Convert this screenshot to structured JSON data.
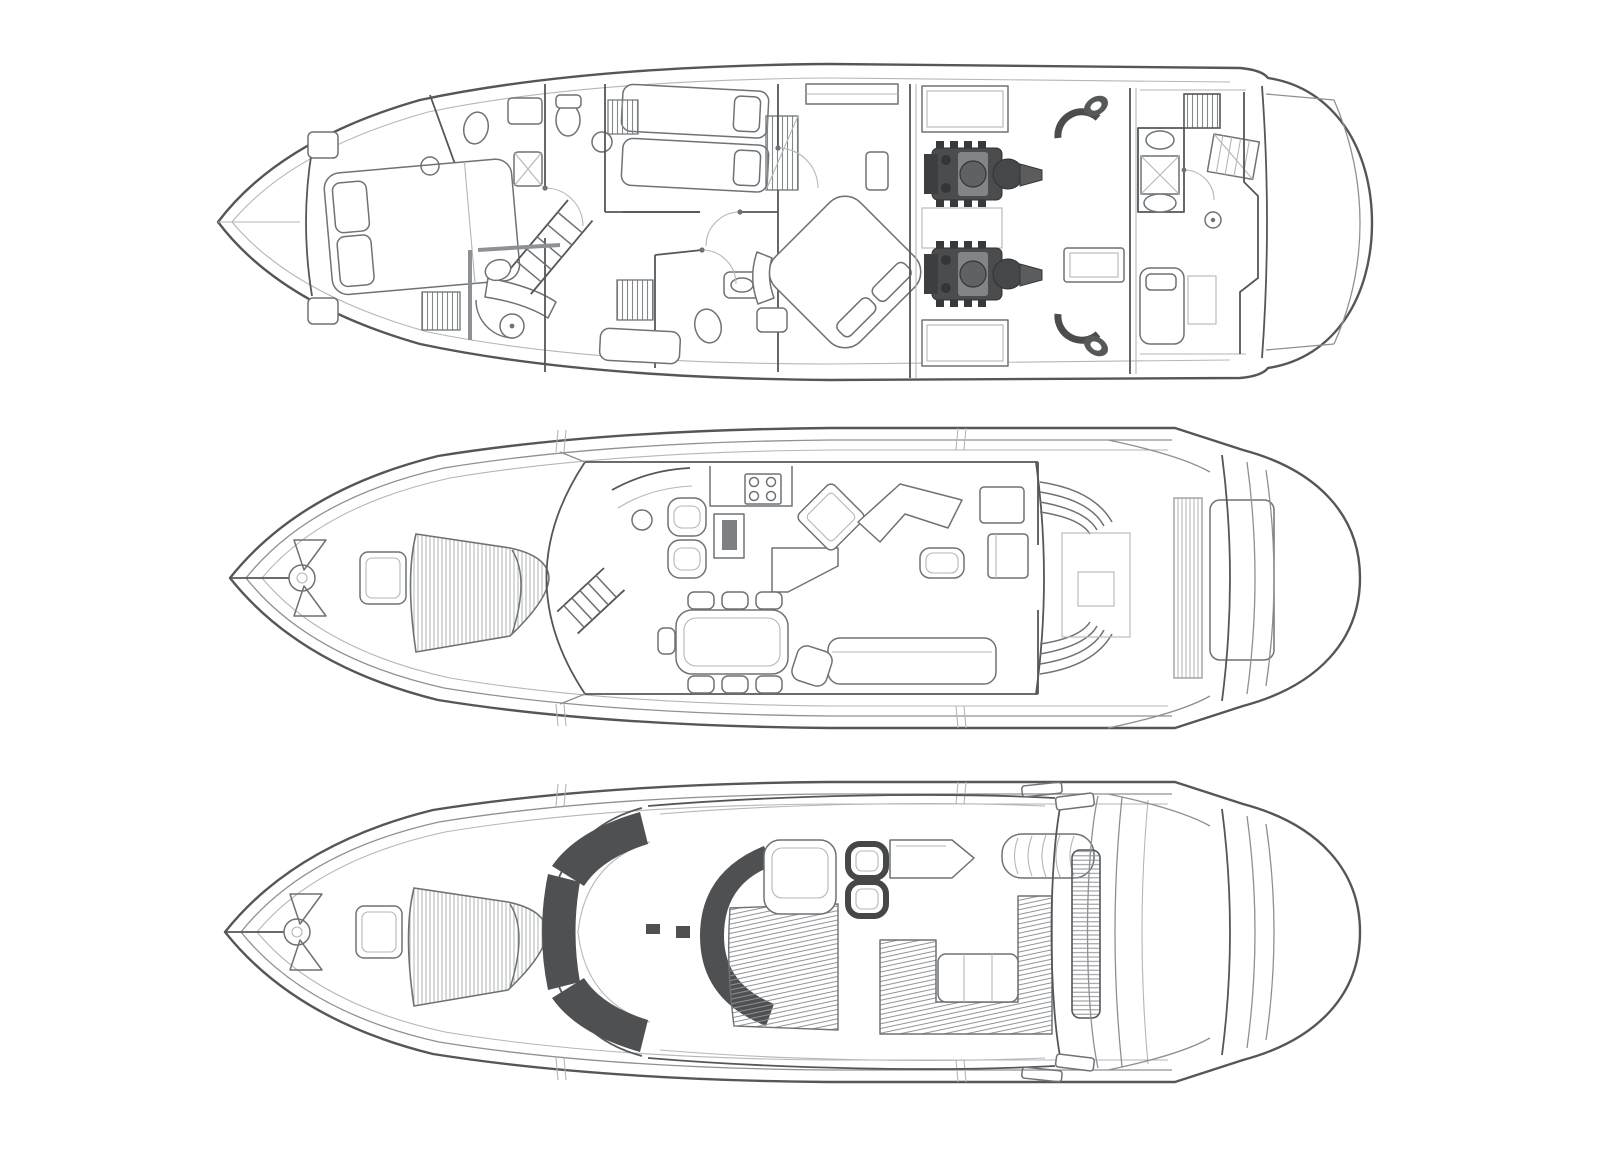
{
  "palette": {
    "background": "#ffffff",
    "line": "#53575a",
    "line-mid": "#6e7276",
    "line-soft": "#8d9094",
    "line-faint": "#b4b6b8",
    "dark": "#4e5052",
    "tint": "#f0f1f1",
    "hatch": "#9a9c9e"
  },
  "diagram": {
    "type": "yacht-general-arrangement",
    "orientation": "bow-left",
    "figure_label": "three stacked deck plans of a motor yacht",
    "decks": [
      {
        "id": "lower-deck",
        "label": "lower-deck-plan"
      },
      {
        "id": "main-deck",
        "label": "main-deck-plan"
      },
      {
        "id": "flybridge",
        "label": "flybridge-plan"
      }
    ],
    "features": {
      "lower_deck": [
        "forward-cabin",
        "heads",
        "staircase",
        "twin-cabin",
        "master-cabin",
        "engine-room",
        "twin-engines",
        "crew-cabin",
        "swim-platform"
      ],
      "main_deck": [
        "anchor-windlass",
        "foredeck-sunpad",
        "helm-station",
        "galley",
        "dinette",
        "saloon",
        "cockpit",
        "swim-platform"
      ],
      "flybridge": [
        "foredeck-sunpad",
        "windscreen",
        "helm-seats",
        "wet-bar",
        "sun-lounger",
        "u-settee",
        "radar-arch"
      ]
    }
  }
}
